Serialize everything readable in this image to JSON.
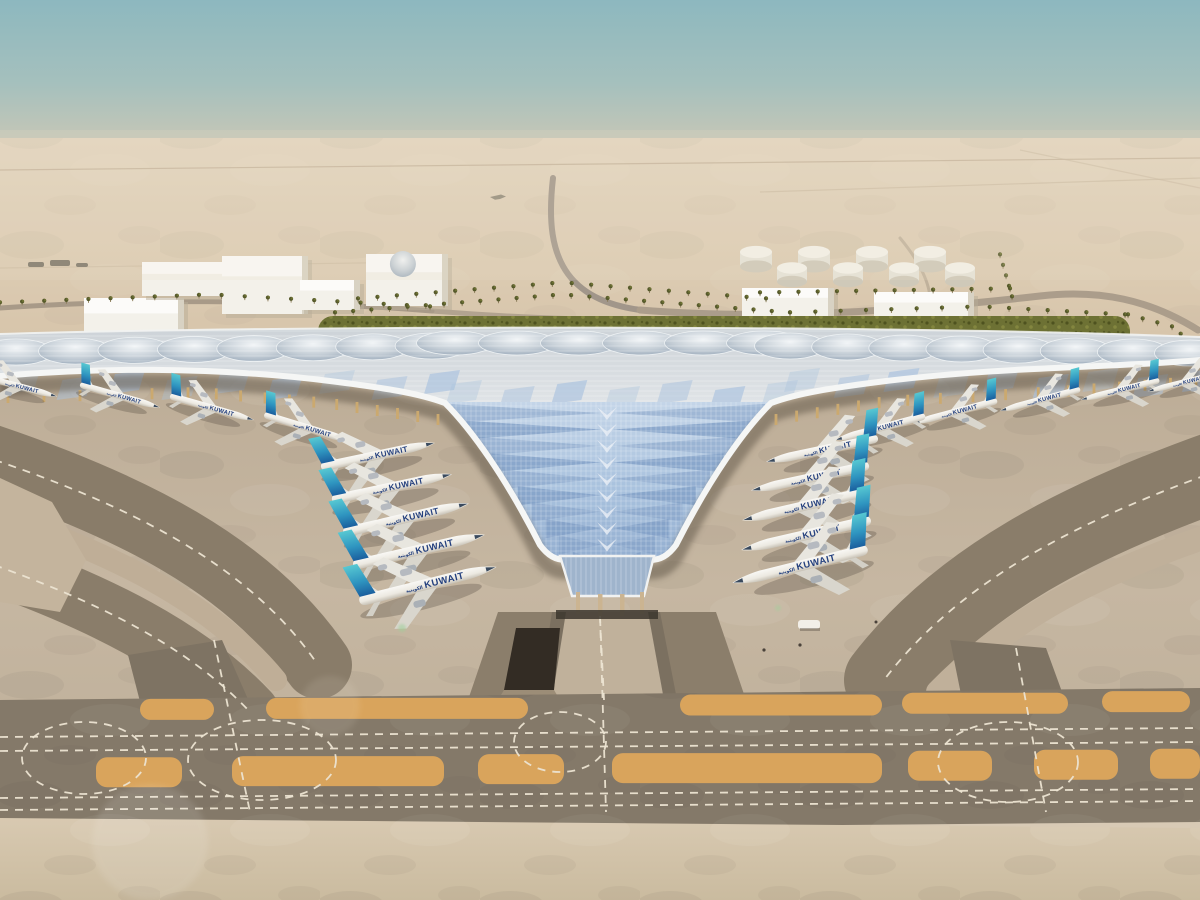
{
  "scene": {
    "kind": "aerial-architectural-rendering-airport-terminal",
    "airline": {
      "title": "KUWAIT",
      "arabic": "الكويتية",
      "text_color": "#24407e"
    },
    "colors": {
      "sky_top": "#8db8bf",
      "sky_horizon": "#d9cbb6",
      "desert_sand": "#dccbb2",
      "roof_white": "#eceeee",
      "roof_glazing_blue": "#a9c2de",
      "roof_steel": "#9fb0c0",
      "green_band": "#6d7134",
      "apron_light": "#c6b7a2",
      "taxiway_dark": "#857a69",
      "blast_pad_orange": "#d9a45c",
      "marking_dash": "#ece4d2",
      "tail_teal_top": "#57c8d2",
      "tail_blue_bottom": "#1b5f9e",
      "fuselage": "#f4f3ef"
    },
    "planes": {
      "left_row": [
        {
          "x": 378,
          "y": 455,
          "s": 1.12,
          "r": -12,
          "d": 1
        },
        {
          "x": 392,
          "y": 487,
          "s": 1.18,
          "r": -12,
          "d": 1
        },
        {
          "x": 406,
          "y": 518,
          "s": 1.24,
          "r": -13,
          "d": 1
        },
        {
          "x": 419,
          "y": 550,
          "s": 1.3,
          "r": -13,
          "d": 1
        },
        {
          "x": 428,
          "y": 584,
          "s": 1.36,
          "r": -14,
          "d": 1
        }
      ],
      "right_row": [
        {
          "x": 822,
          "y": 450,
          "s": 1.1,
          "r": -12,
          "d": -1
        },
        {
          "x": 810,
          "y": 478,
          "s": 1.16,
          "r": -12,
          "d": -1
        },
        {
          "x": 804,
          "y": 506,
          "s": 1.22,
          "r": -13,
          "d": -1
        },
        {
          "x": 806,
          "y": 535,
          "s": 1.28,
          "r": -13,
          "d": -1
        },
        {
          "x": 800,
          "y": 566,
          "s": 1.34,
          "r": -14,
          "d": -1
        }
      ],
      "canopy_left": [
        {
          "x": 18,
          "y": 386,
          "s": 0.78,
          "r": 15,
          "d": 1
        },
        {
          "x": 120,
          "y": 396,
          "s": 0.8,
          "r": 16,
          "d": 1
        },
        {
          "x": 212,
          "y": 408,
          "s": 0.84,
          "r": 16,
          "d": 1
        },
        {
          "x": 308,
          "y": 428,
          "s": 0.88,
          "r": 17,
          "d": 1
        }
      ],
      "canopy_right": [
        {
          "x": 1040,
          "y": 400,
          "s": 0.8,
          "r": -15,
          "d": -1
        },
        {
          "x": 1120,
          "y": 390,
          "s": 0.78,
          "r": -14,
          "d": -1
        },
        {
          "x": 1185,
          "y": 382,
          "s": 0.74,
          "r": -14,
          "d": -1
        },
        {
          "x": 955,
          "y": 412,
          "s": 0.84,
          "r": -15,
          "d": -1
        },
        {
          "x": 880,
          "y": 428,
          "s": 0.9,
          "r": -15,
          "d": -1
        }
      ]
    },
    "background": {
      "buildings": [
        {
          "x": 84,
          "y": 298,
          "w": 100,
          "h": 44
        },
        {
          "x": 142,
          "y": 262,
          "w": 94,
          "h": 34
        },
        {
          "x": 222,
          "y": 256,
          "w": 86,
          "h": 58
        },
        {
          "x": 300,
          "y": 280,
          "w": 60,
          "h": 30
        },
        {
          "x": 366,
          "y": 254,
          "w": 82,
          "h": 52,
          "dome": true
        },
        {
          "x": 742,
          "y": 288,
          "w": 92,
          "h": 28
        },
        {
          "x": 874,
          "y": 292,
          "w": 100,
          "h": 30
        }
      ],
      "tank_rows": [
        {
          "x0": 756,
          "y": 252,
          "n": 4,
          "dx": 58,
          "r": 16
        },
        {
          "x0": 792,
          "y": 268,
          "n": 4,
          "dx": 56,
          "r": 15
        }
      ],
      "palm_rows": [
        {
          "pts": [
            [
              0,
              306
            ],
            [
              210,
              298
            ],
            [
              430,
              310
            ]
          ],
          "n": 20
        },
        {
          "pts": [
            [
              335,
              316
            ],
            [
              562,
              298
            ],
            [
              790,
              316
            ]
          ],
          "n": 26
        },
        {
          "pts": [
            [
              358,
              302
            ],
            [
              562,
              286
            ],
            [
              766,
              302
            ]
          ],
          "n": 22
        },
        {
          "pts": [
            [
              790,
              316
            ],
            [
              980,
              310
            ],
            [
              1125,
              318
            ]
          ],
          "n": 16
        },
        {
          "pts": [
            [
              1128,
              318
            ],
            [
              1172,
              330
            ],
            [
              1198,
              352
            ]
          ],
          "n": 7
        },
        {
          "pts": [
            [
              1000,
              258
            ],
            [
              1012,
              300
            ]
          ],
          "n": 5
        },
        {
          "pts": [
            [
              760,
              296
            ],
            [
              1010,
              292
            ]
          ],
          "n": 14
        }
      ]
    },
    "roof": {
      "dome_rows": [
        {
          "x0": 16,
          "x1": 432,
          "n": 8,
          "cy0": 352,
          "cy1": 346,
          "ry": 13
        },
        {
          "x0": 455,
          "x1": 765,
          "n": 6,
          "cy0": 343,
          "cy1": 343,
          "ry": 12
        },
        {
          "x0": 790,
          "x1": 1190,
          "n": 8,
          "cy0": 346,
          "cy1": 353,
          "ry": 13
        }
      ],
      "glint_rows": [
        {
          "x0": 10,
          "x1": 430,
          "n": 9,
          "y": 370
        },
        {
          "x0": 452,
          "x1": 768,
          "n": 7,
          "y": 380
        },
        {
          "x0": 790,
          "x1": 1188,
          "n": 9,
          "y": 368
        }
      ],
      "chevrons": {
        "cx": 607,
        "yTop": 404,
        "yBot": 552,
        "rows": 10,
        "halfTop": 158,
        "halfBot": 34
      },
      "colonnade": {
        "left": [
          [
            8,
            386
          ],
          [
            200,
            381
          ],
          [
            330,
            392
          ],
          [
            438,
            408
          ]
        ],
        "right": [
          [
            776,
            408
          ],
          [
            886,
            390
          ],
          [
            1060,
            380
          ],
          [
            1196,
            370
          ]
        ]
      }
    },
    "ground": {
      "orange_row1": {
        "y": 700,
        "h": 21,
        "spans": [
          [
            140,
            74
          ],
          [
            266,
            262
          ],
          [
            680,
            202
          ],
          [
            902,
            166
          ],
          [
            1102,
            88
          ]
        ]
      },
      "orange_row2": {
        "y": 758,
        "h": 30,
        "spans": [
          [
            96,
            86
          ],
          [
            232,
            212
          ],
          [
            478,
            86
          ],
          [
            612,
            270
          ],
          [
            908,
            84
          ],
          [
            1034,
            84
          ],
          [
            1150,
            50
          ]
        ]
      },
      "dash_lines_y": [
        737,
        751,
        798,
        810
      ],
      "junction_arcs": [
        [
          84,
          758,
          62,
          36
        ],
        [
          262,
          760,
          74,
          40
        ],
        [
          560,
          742,
          46,
          30
        ],
        [
          1008,
          762,
          70,
          40
        ]
      ],
      "connector_dashes": [
        [
          214,
          640,
          250,
          812
        ],
        [
          600,
          615,
          606,
          812
        ],
        [
          1016,
          648,
          1046,
          812
        ]
      ]
    }
  }
}
